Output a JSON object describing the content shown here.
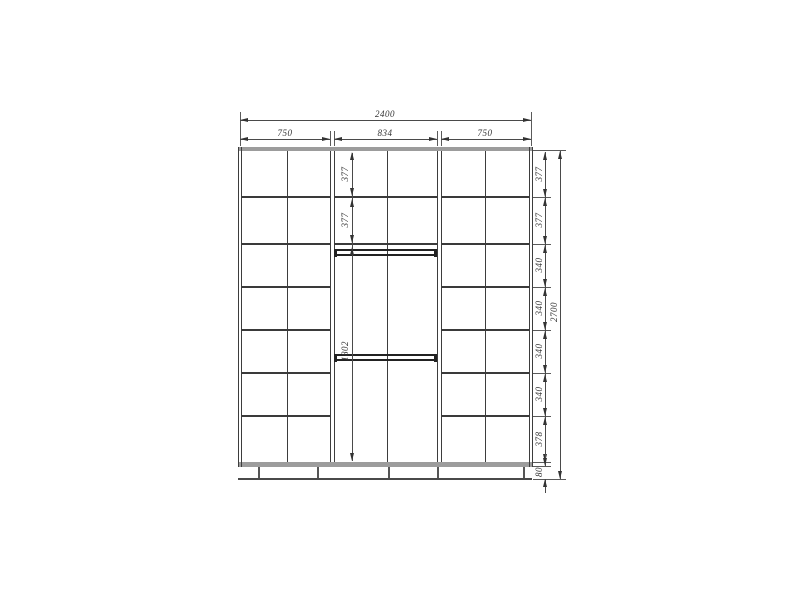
{
  "drawing": {
    "type": "wardrobe-front-elevation",
    "dimensions": {
      "overall_width": "2400",
      "overall_height": "2700",
      "section_widths": [
        "750",
        "834",
        "750"
      ],
      "middle_column_rows": [
        "377",
        "377",
        "1802"
      ],
      "right_column_rows": [
        "377",
        "377",
        "340",
        "340",
        "340",
        "340",
        "378"
      ],
      "plinth_height": "80"
    },
    "colors": {
      "line": "#3a3a3a",
      "dimension": "#4a4a4a",
      "panel_band": "#9c9c9c",
      "background": "#ffffff"
    }
  }
}
